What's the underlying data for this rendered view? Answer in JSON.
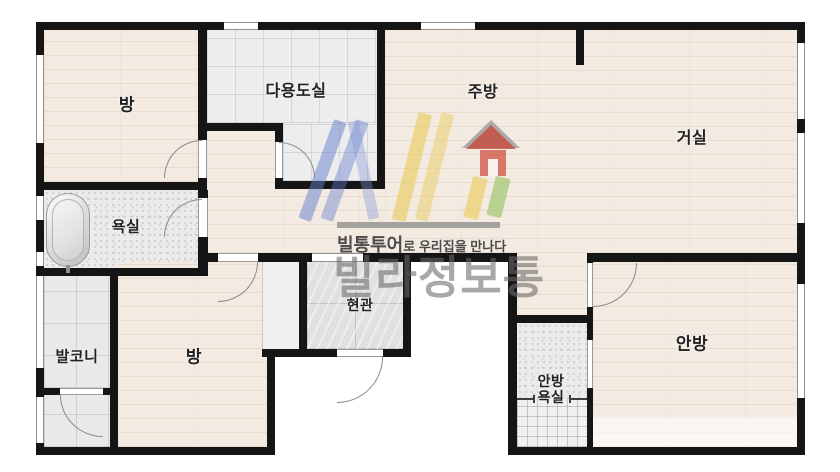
{
  "floorplan": {
    "rooms": [
      {
        "id": "room-top-left",
        "label": "방"
      },
      {
        "id": "utility-room",
        "label": "다용도실"
      },
      {
        "id": "kitchen",
        "label": "주방"
      },
      {
        "id": "living-room",
        "label": "거실"
      },
      {
        "id": "bathroom",
        "label": "욕실"
      },
      {
        "id": "balcony",
        "label": "발코니"
      },
      {
        "id": "room-bottom",
        "label": "방"
      },
      {
        "id": "entrance",
        "label": "현관"
      },
      {
        "id": "master-bedroom",
        "label": "안방"
      },
      {
        "id": "master-bathroom",
        "label_line1": "안방",
        "label_line2": "욕실"
      }
    ],
    "watermark": {
      "brand": "빌통투어",
      "slogan_suffix": "로 우리집을 만나다",
      "big_text": "빌라정보통",
      "logo_colors": {
        "v_blue": "#6e86d8",
        "l_yellow": "#e5c554",
        "house_red": "#c9483f",
        "bar_green": "#93bf62"
      }
    },
    "colors": {
      "wall": "#151515",
      "wood_floor": "#f3eae1",
      "tile": "#ededed",
      "background": "#ffffff"
    }
  }
}
